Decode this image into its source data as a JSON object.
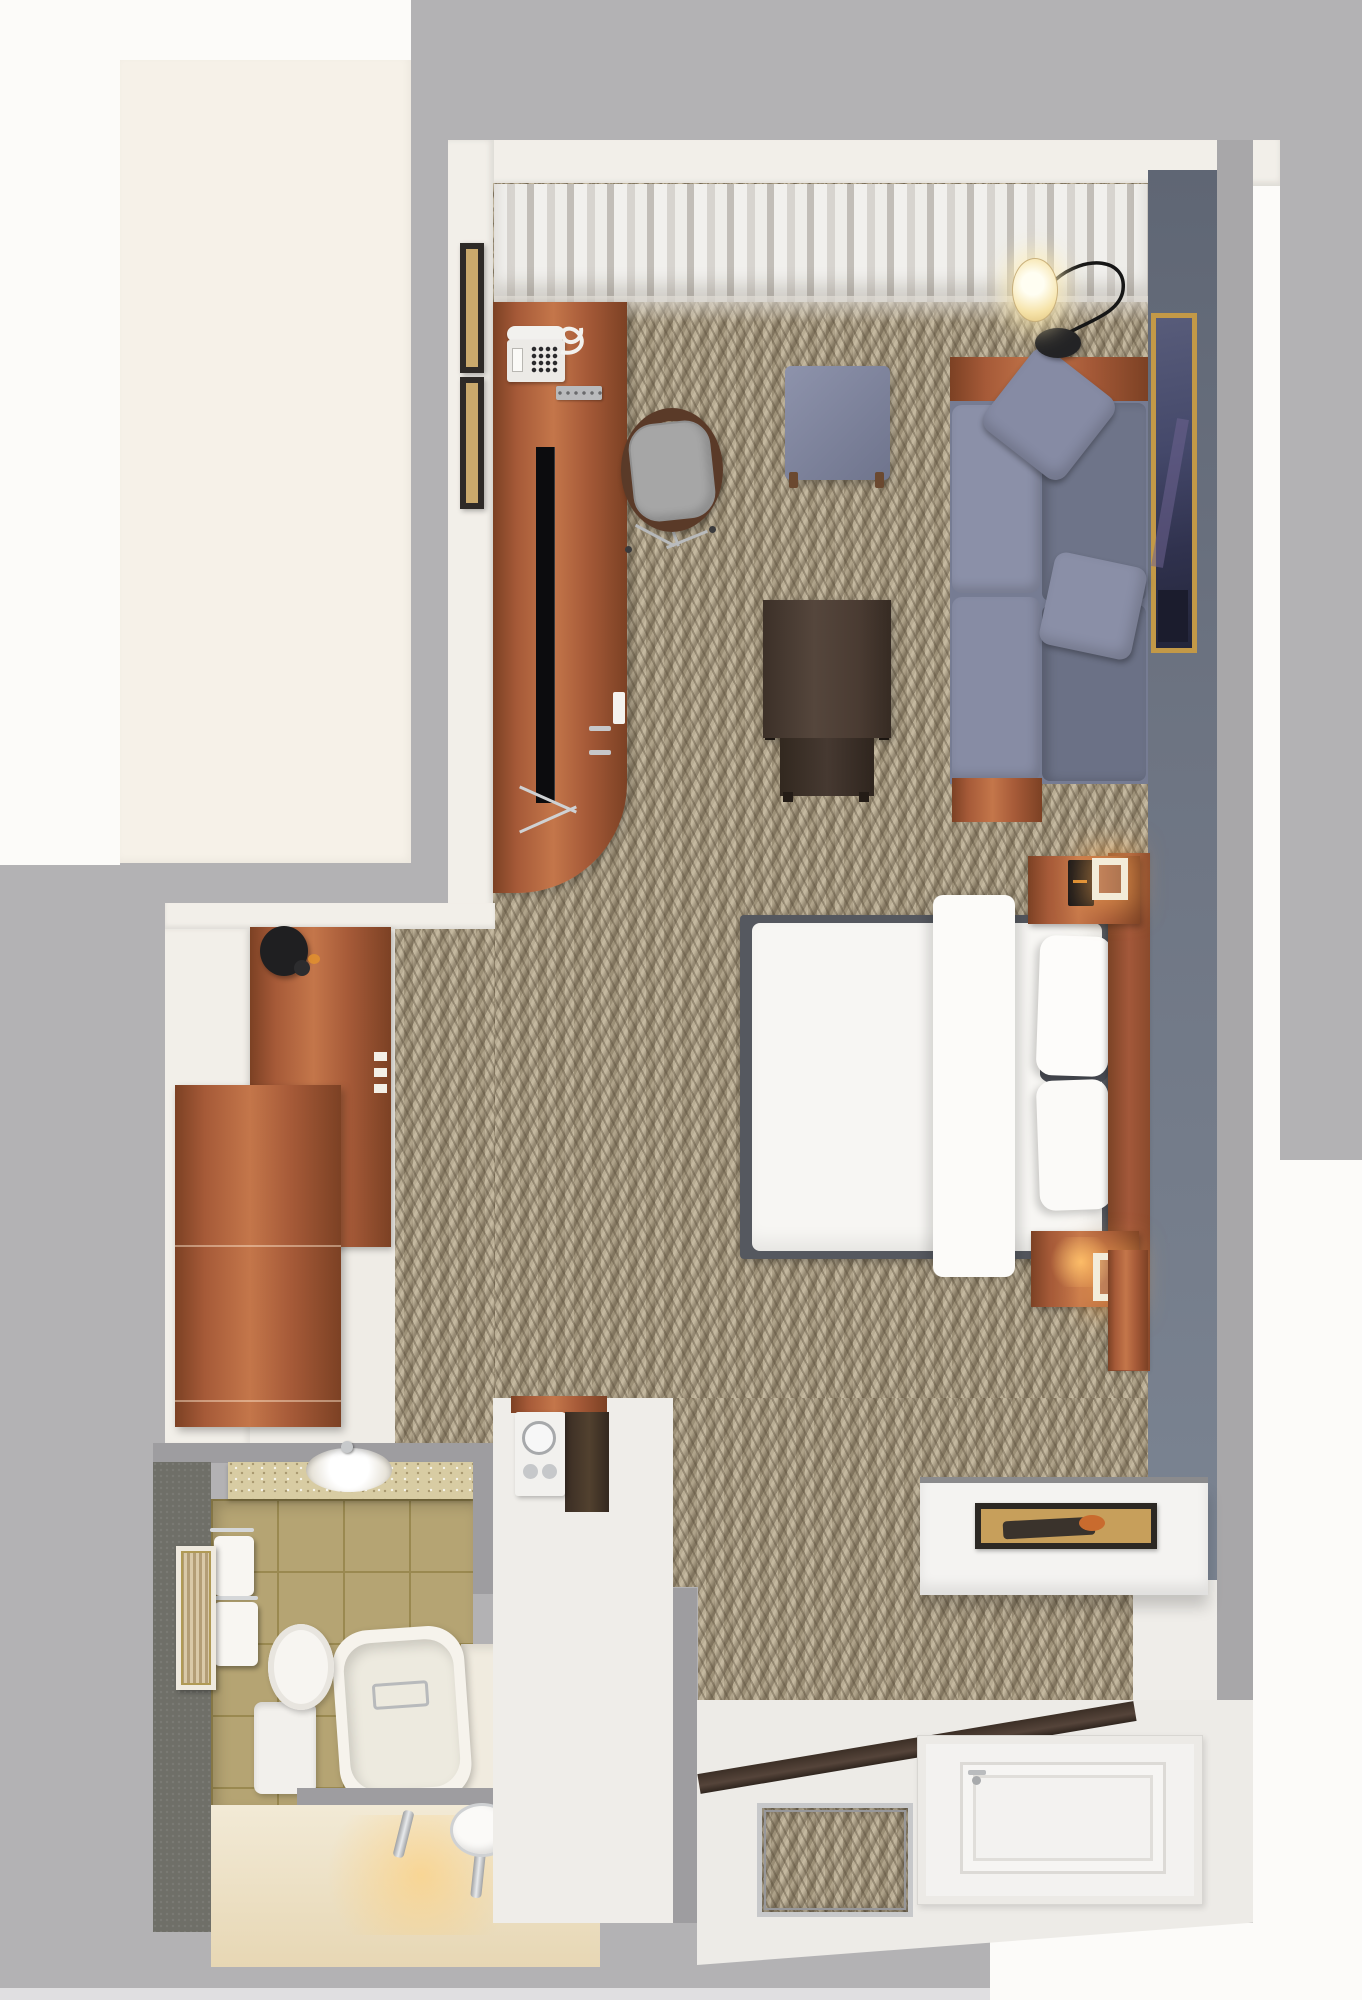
{
  "scene": {
    "kind": "3d-top-down-floorplan-render",
    "subject": "hotel guest room with living area, king bed, closet, bathroom and entry",
    "visible_text": "none"
  },
  "palette": {
    "bg_gray": "#b3b2b4",
    "outer_white": "#fcfbf9",
    "cream": "#f6f1e8",
    "wall_white": "#f2efe9",
    "wall_band": "#9e9da0",
    "wall_core": "#a8a7a9",
    "bottom_strip": "#e0dfe1",
    "carpet_base": "#ab9e85",
    "wood": "#a65a38",
    "wood_dark": "#7c4124",
    "wood_light": "#c4764a",
    "walnut": "#4b3b31",
    "fabric_blue": "#7e8399",
    "bed_white": "#f7f6f3",
    "bed_frame": "#55585f",
    "accent_wall": "#6b7383",
    "art_gold": "#c39947",
    "tile": "#b5a473",
    "tile_line": "#9a8950",
    "tile_light": "#cfc49c",
    "bath_wall": "#6f6f68",
    "granite": "#d8cca3",
    "glow_warm": "#ffc979",
    "chrome": "#c7c9cb",
    "entry_white": "#edebe7",
    "door_white": "#f3f2f0"
  },
  "rooms": [
    {
      "name": "living-area",
      "floor": "herringbone-carpet"
    },
    {
      "name": "sleeping-area",
      "floor": "herringbone-carpet"
    },
    {
      "name": "closet-nook",
      "floor": "white"
    },
    {
      "name": "bathroom",
      "floor": "tan-tile"
    },
    {
      "name": "entry-hall",
      "floor": "white-tile"
    }
  ],
  "furniture": [
    {
      "name": "media-desk",
      "room": "living-area",
      "items": [
        "telephone",
        "remote-control",
        "flat-tv"
      ]
    },
    {
      "name": "desk-chair",
      "room": "living-area"
    },
    {
      "name": "ottoman",
      "room": "living-area"
    },
    {
      "name": "coffee-table",
      "room": "living-area"
    },
    {
      "name": "sofa",
      "room": "living-area",
      "pillows": 2
    },
    {
      "name": "arc-floor-lamp",
      "room": "living-area",
      "state": "on"
    },
    {
      "name": "wall-art-gold-frame",
      "room": "living-area"
    },
    {
      "name": "wall-frames",
      "room": "living-area",
      "count": 2
    },
    {
      "name": "king-bed",
      "room": "sleeping-area",
      "pillows": 3
    },
    {
      "name": "headboard",
      "room": "sleeping-area"
    },
    {
      "name": "nightstand-with-lamp",
      "room": "sleeping-area",
      "count": 2,
      "lamps": "on"
    },
    {
      "name": "clock-radio",
      "room": "sleeping-area"
    },
    {
      "name": "wardrobe",
      "room": "closet-nook"
    },
    {
      "name": "dresser",
      "room": "closet-nook"
    },
    {
      "name": "wall-hook-disc",
      "room": "closet-nook"
    },
    {
      "name": "coffee-station",
      "room": "entry-hall"
    },
    {
      "name": "vanity-counter-sink",
      "room": "bathroom"
    },
    {
      "name": "toilet",
      "room": "bathroom"
    },
    {
      "name": "bathtub",
      "room": "bathroom"
    },
    {
      "name": "towels",
      "room": "bathroom",
      "count": 2
    },
    {
      "name": "bathroom-art",
      "room": "bathroom"
    },
    {
      "name": "double-faucet-vanity",
      "room": "bathroom",
      "state": "lit"
    },
    {
      "name": "console-shelf-with-art",
      "room": "entry-hall"
    },
    {
      "name": "entry-door",
      "room": "entry-hall"
    },
    {
      "name": "recessed-entry-mat",
      "room": "entry-hall"
    }
  ]
}
